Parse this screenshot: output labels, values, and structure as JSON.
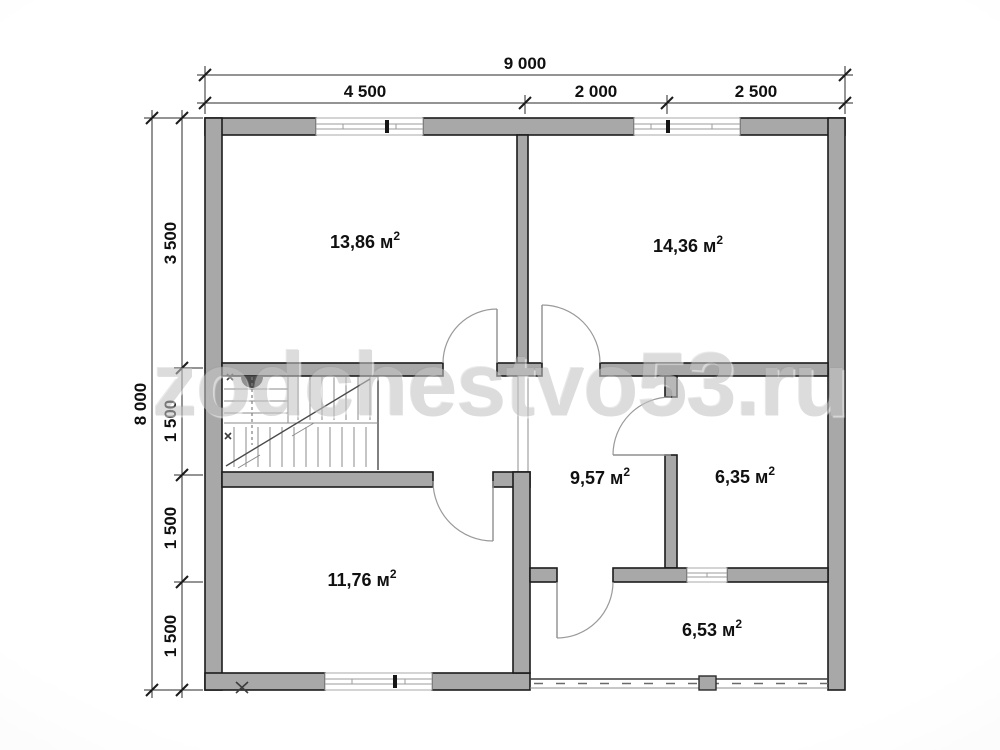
{
  "watermark": {
    "text": "zodchestvo53.ru"
  },
  "dimensions": {
    "top_total": "9 000",
    "top_segments": [
      "4 500",
      "2 000",
      "2 500"
    ],
    "left_total": "8 000",
    "left_segments": [
      "3 500",
      "1 500",
      "1 500",
      "1 500"
    ]
  },
  "rooms": [
    {
      "name": "room-top-left",
      "area": "13,86 м",
      "sup": "2"
    },
    {
      "name": "room-top-right",
      "area": "14,36 м",
      "sup": "2"
    },
    {
      "name": "room-hall",
      "area": "9,57 м",
      "sup": "2"
    },
    {
      "name": "room-small-right",
      "area": "6,35 м",
      "sup": "2"
    },
    {
      "name": "room-bottom-left",
      "area": "11,76 м",
      "sup": "2"
    },
    {
      "name": "room-bottom-right",
      "area": "6,53 м",
      "sup": "2"
    }
  ],
  "colors": {
    "wall-fill": "#a8a8a8",
    "wall-outline": "#1c1c1c",
    "dim-line": "#2a2a2a",
    "label-text": "#101010",
    "watermark": "#c4c4c4"
  }
}
